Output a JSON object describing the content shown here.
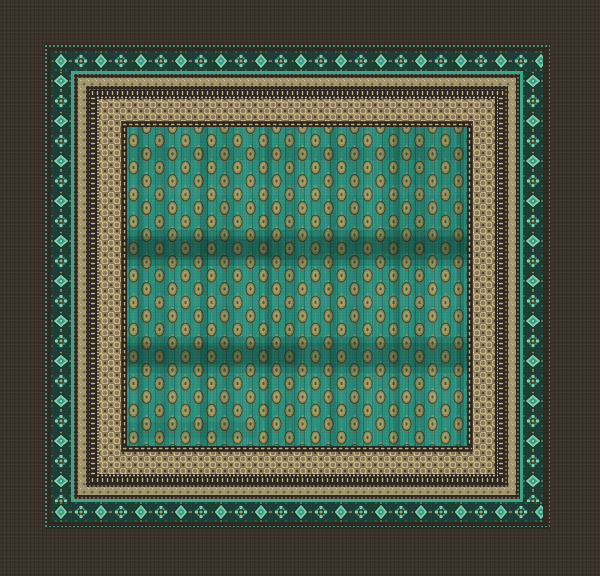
{
  "scene": {
    "alt": "Square ornamental jacquard tablecloth with a teal paisley center field and layered decorative borders, lying on dark brown linen fabric"
  },
  "colors": {
    "linenBase": "#3b332b",
    "linenWeft": "#4a4036",
    "bandDark": "#2f2922",
    "tealDot": "#3fb796",
    "tealLine": "#35a98c",
    "diamGround": "#1e3d34",
    "diamMint": "#84d0ad",
    "diamTeal": "#2f9d85",
    "diamOutline": "#14312a",
    "accentGold": "#b9a264",
    "khakiBase": "#a2976f",
    "khakiDot": "#6b5f45",
    "khakiSpeck": "#d6c99c",
    "goldDot": "#bfa978",
    "tickGround": "#2a2621",
    "tickGold": "#c9b482",
    "beadLight": "#dcc89a",
    "scrollBase": "#8c7a58",
    "scrollLight": "#d4c193",
    "scrollDark": "#463b2b",
    "dashGround": "#292520",
    "dashGold": "#c2ab77",
    "fieldTeal": "#2b8f7d",
    "fieldTealDark": "#1d6a5c",
    "fieldTealLight": "#3aa58e",
    "motifOlive": "#8f8f58",
    "motifOliveLight": "#a89f66",
    "motifOutline": "#3f402a",
    "motifCenter": "#54543a",
    "copper": "#8a6a44",
    "shade": "#06251f"
  },
  "bands_outside_in": [
    "teal dotted hem line",
    "dark gap",
    "teal diamond and rosette band",
    "bright teal line",
    "dark line with gold specks",
    "khaki band with olive dots",
    "dark line with gold specks",
    "gold tick comb band",
    "gold bead line",
    "wide gold filigree scroll band",
    "gold dash band",
    "teal paisley center field"
  ]
}
